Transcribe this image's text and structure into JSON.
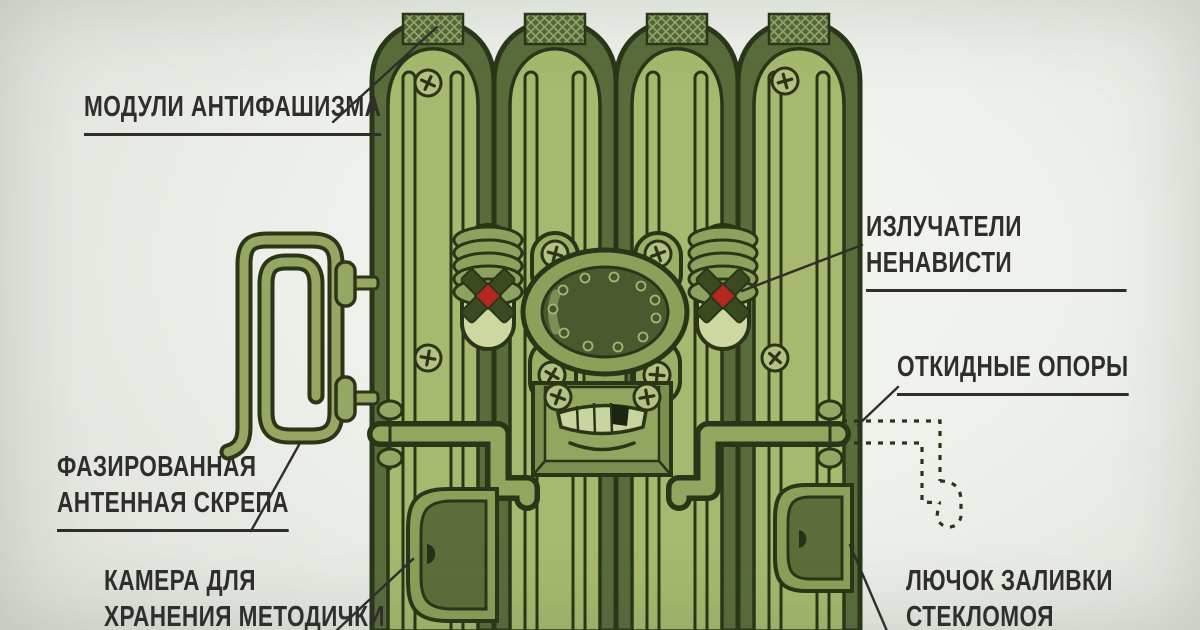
{
  "title": "Satirical military propaganda-machine infographic (Russian)",
  "labels": {
    "modules": {
      "text": "МОДУЛИ АНТИФАШИЗМА"
    },
    "emitters": {
      "text": "ИЗЛУЧАТЕЛИ НЕНАВИСТИ"
    },
    "supports": {
      "text": "ОТКИДНЫЕ ОПОРЫ"
    },
    "antenna": {
      "text": "ФАЗИРОВАННАЯ\nАНТЕННАЯ СКРЕПА"
    },
    "camera": {
      "text": "КАМЕРА ДЛЯ\nХРАНЕНИЯ МЕТОДИЧКИ"
    },
    "hatch": {
      "text": "ЛЮЧОК ЗАЛИВКИ\nСТЕКЛОМОЯ"
    }
  },
  "machine": {
    "parts": [
      "antifascism-modules (four tube tops with mesh)",
      "hate-emitters (capsule eyes with X and red core)",
      "central-riveted-port (oval plate)",
      "grumpy-mouth-plate",
      "folding-supports (hinged arms, dashed unfolded ghost)",
      "phased-antenna-paperclip",
      "storage-hatch (bottom left)",
      "washer-filler-hatch (bottom right)"
    ],
    "colors": {
      "outline": "#2b3618",
      "body_green": "#a6b96e",
      "cap_dark_green": "#5a6c3c",
      "panel_mid_green": "#93a65f",
      "eye_capsule": "#ccd8a0",
      "oval_inner": "#4b5930",
      "red_core": "#b5281e",
      "label_text": "#2e2f2b",
      "background": "#edf0ea"
    }
  }
}
